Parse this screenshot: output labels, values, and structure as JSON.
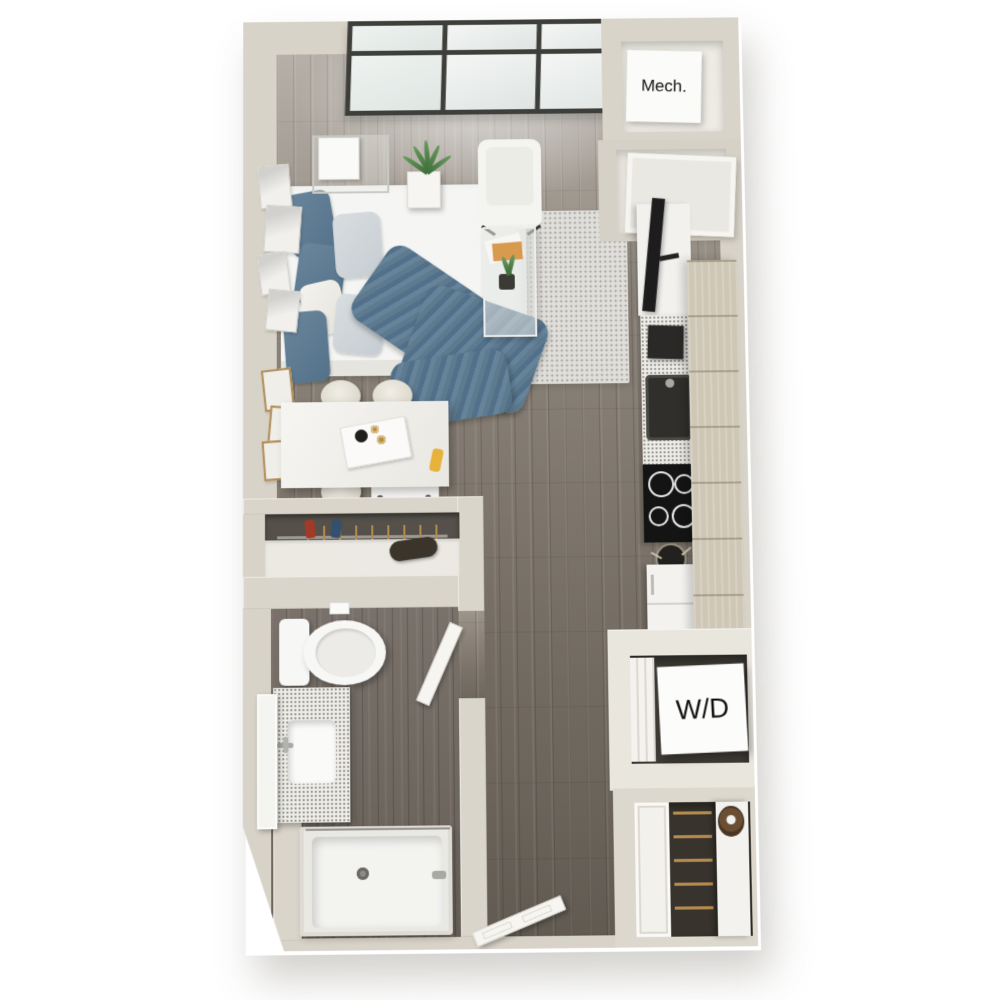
{
  "image": {
    "kind": "3D rendered top-down floor plan",
    "unit_type": "studio apartment",
    "background": "#ffffff"
  },
  "labels": {
    "mechanical_closet": "Mech.",
    "washer_dryer": "W/D"
  },
  "palette": {
    "wall": "#d8d3c8",
    "wall_inner": "#edebe3",
    "floor_wood": "#847c72",
    "floor_wood_dark": "#6f6860",
    "rug": "#e0deda",
    "bedding_blue": "#587690",
    "window_frame": "#3e3e3b",
    "cabinet_tan": "#cfc7b6",
    "fixture_white": "#f4f3f0",
    "appliance_dark": "#1d1d1d",
    "hanger_tan": "#b48b4f",
    "wreath_brown": "#6b4f34"
  },
  "rooms": [
    "living-sleeping-area",
    "kitchen",
    "dining-nook",
    "reach-in-closet",
    "bathroom",
    "mechanical-closet",
    "laundry-closet",
    "coat-closet",
    "entry"
  ],
  "furniture": [
    "bed",
    "pillows",
    "throw-blanket",
    "nightstand",
    "table-lamp",
    "wall-art-frames",
    "potted-plant",
    "armchair",
    "area-rug",
    "glass-coffee-table",
    "magazines",
    "dining-table",
    "serving-tray",
    "stools",
    "utility-cart",
    "tv",
    "media-cabinet",
    "kitchen-counter",
    "coffee-maker",
    "kitchen-sink",
    "cooktop",
    "utensil-crock",
    "refrigerator",
    "upper-cabinets",
    "toilet",
    "vanity-sink",
    "mirror",
    "bathtub-shower",
    "washer-dryer-unit",
    "bifold-door",
    "hangers",
    "duffel-bag",
    "entry-door",
    "coat-closet-door",
    "wreath",
    "window-wall"
  ]
}
